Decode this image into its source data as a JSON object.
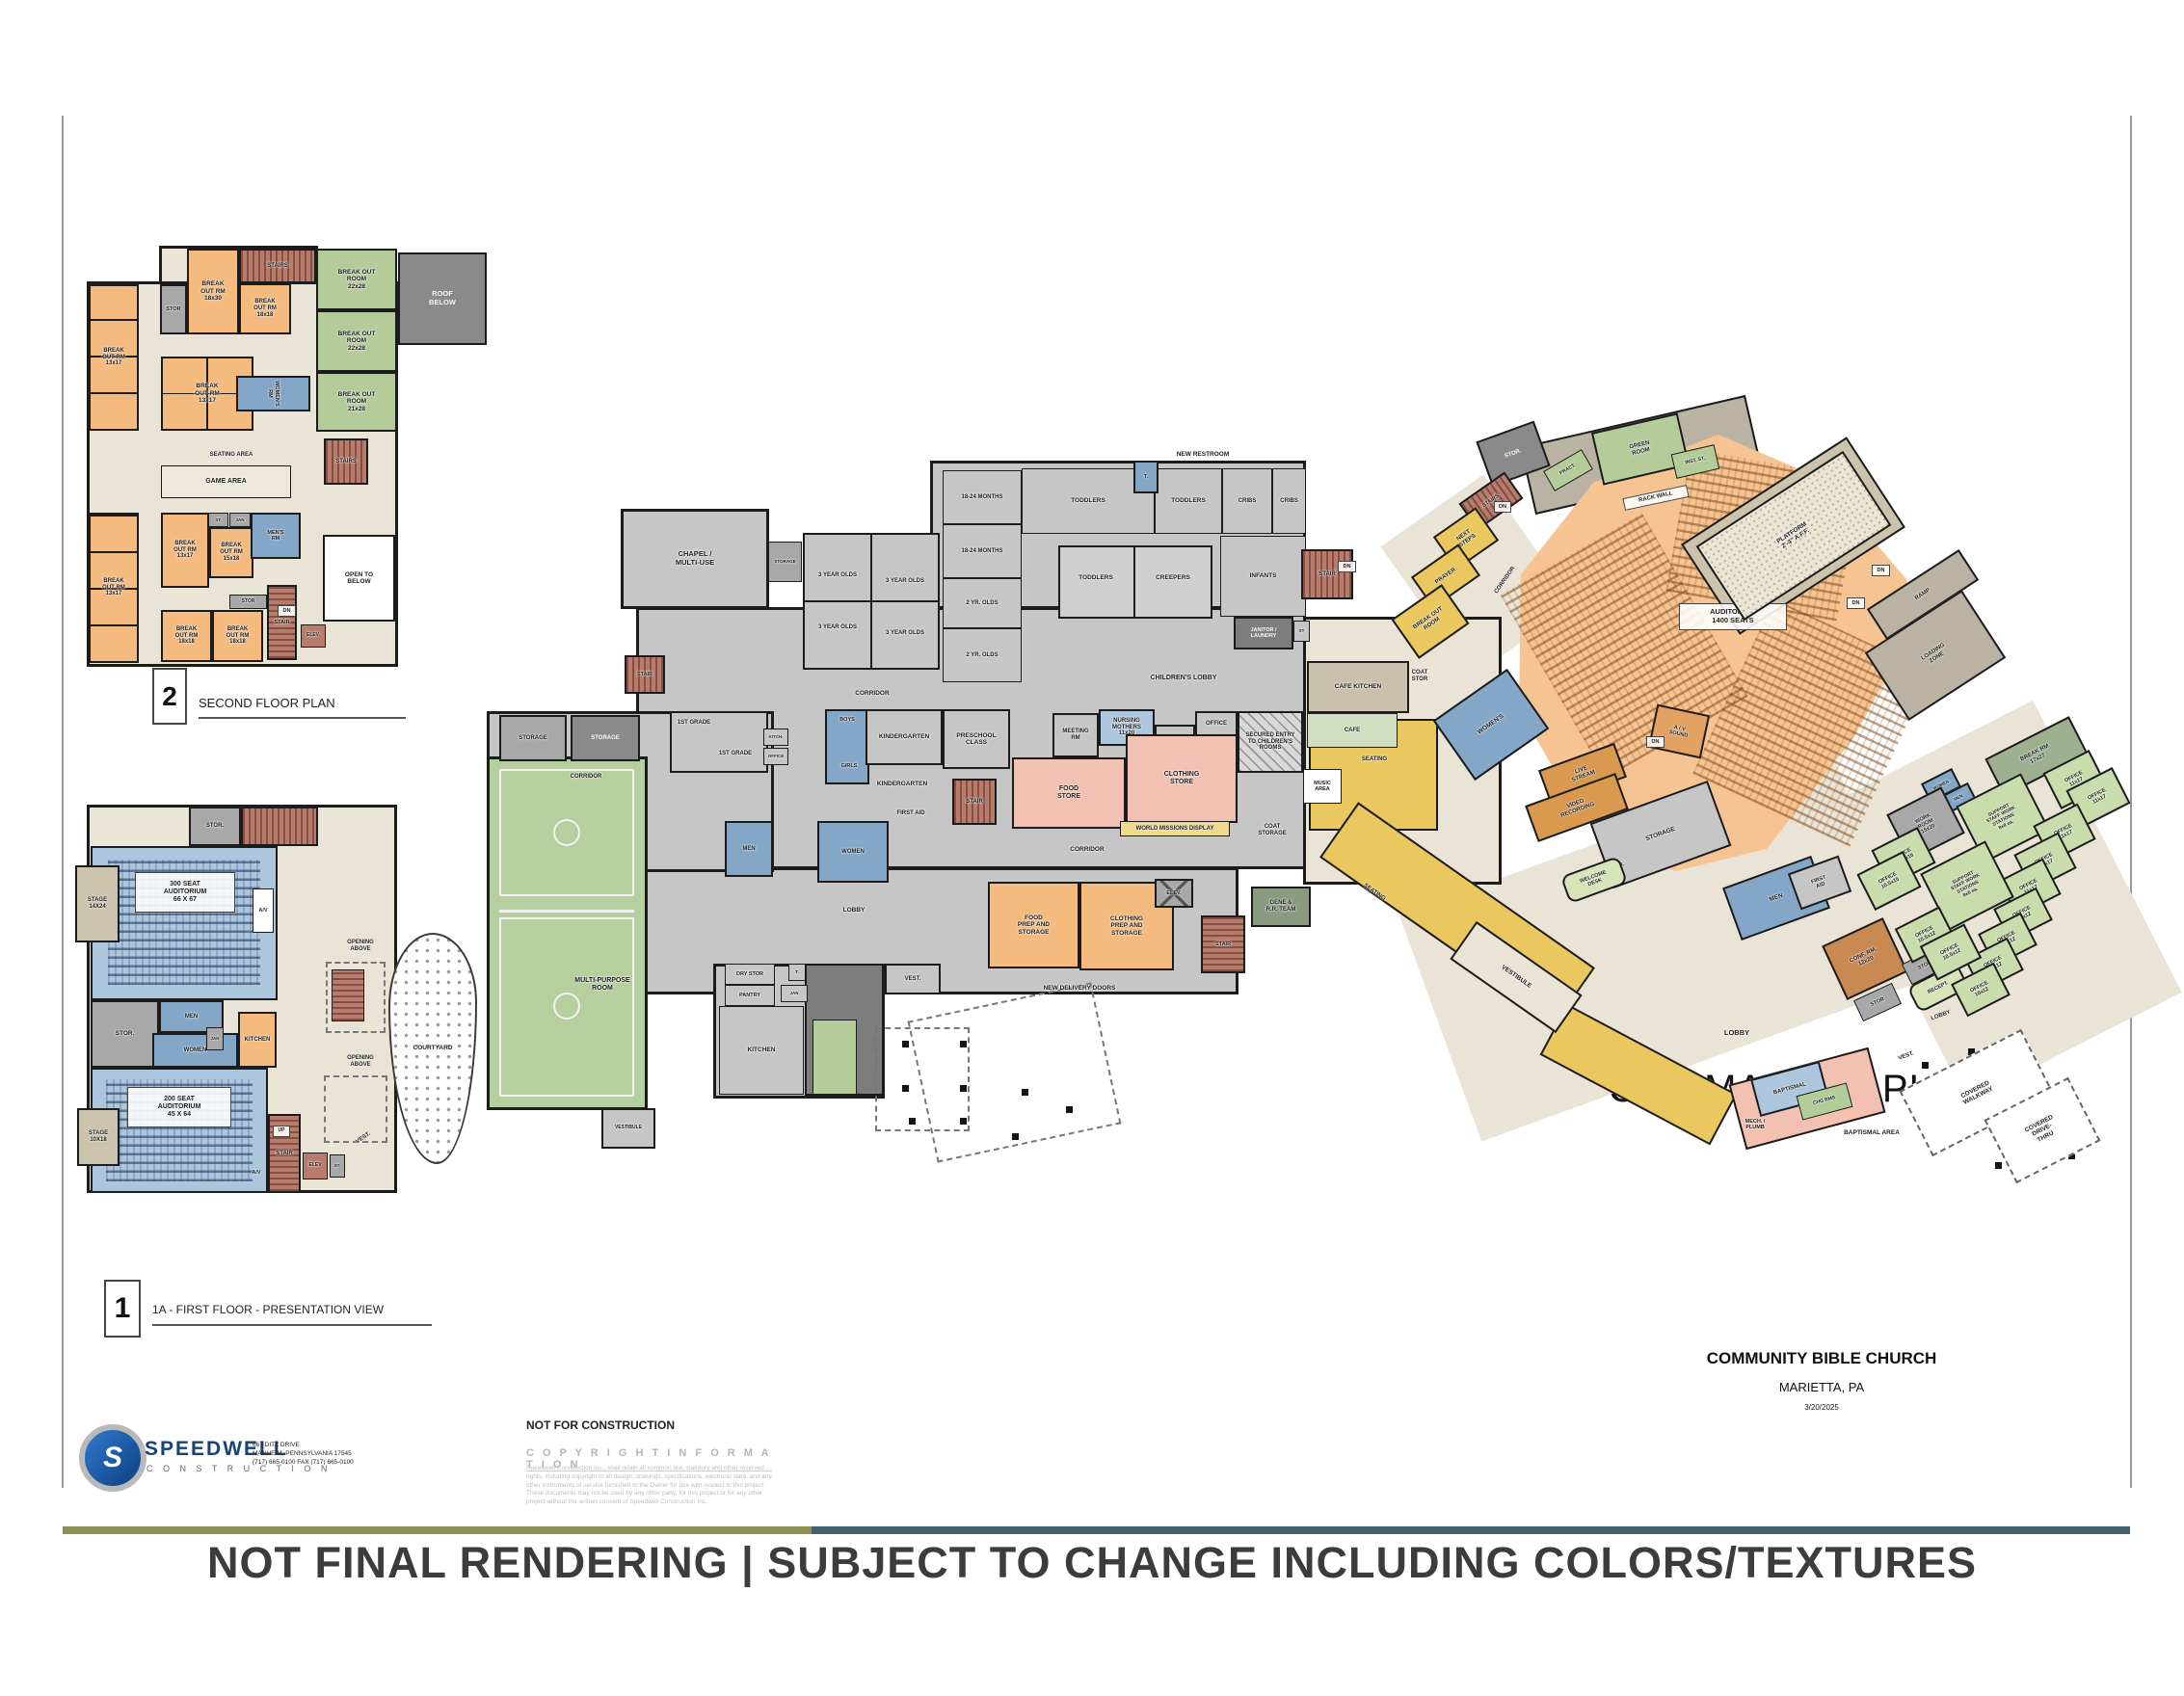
{
  "title": "CBC MASTER PLAN",
  "plans": {
    "second": {
      "number": "2",
      "label": "SECOND FLOOR PLAN"
    },
    "first": {
      "number": "1",
      "label": "1A - FIRST FLOOR - PRESENTATION VIEW"
    }
  },
  "footer": {
    "company": "SPEEDWELL",
    "company_sub": "C O N S T R U C T I O N",
    "address_line1": "667 DITZ DRIVE",
    "address_line2": "MANHEIM, PENNSYLVANIA 17545",
    "address_line3": "(717) 665-0100  FAX (717) 665-0100",
    "not_for_construction": "NOT FOR CONSTRUCTION",
    "copyright_title": "C O P Y R I G H T   I N F O R M A T I O N",
    "copyright_body": "Speedwell Construction Inc., shall retain all common law, statutory and other reserved rights, including copyright to all design, drawings, specifications, electronic data, and any other instruments of service furnished to the Owner for use with respect to this project. These documents may not be used by any other party, for this project or for any other project without the written consent of Speedwell Construction Inc.",
    "project": "COMMUNITY BIBLE CHURCH",
    "location": "MARIETTA, PA",
    "date": "3/20/2025",
    "disclaimer": "NOT FINAL RENDERING | SUBJECT TO CHANGE INCLUDING COLORS/TEXTURES"
  },
  "rooms": [
    {
      "id": "s_stairs_top",
      "label": "STAIRS"
    },
    {
      "id": "s_bo22a",
      "label": "BREAK OUT\nROOM\n22x28"
    },
    {
      "id": "s_bo22b",
      "label": "BREAK OUT\nROOM\n22x28"
    },
    {
      "id": "s_bo21",
      "label": "BREAK OUT\nROOM\n21x28"
    },
    {
      "id": "s_roof",
      "label": "ROOF\nBELOW"
    },
    {
      "id": "s_stor_top",
      "label": "STOR"
    },
    {
      "id": "s_bo1830",
      "label": "BREAK\nOUT RM\n18x30"
    },
    {
      "id": "s_bo1818",
      "label": "BREAK\nOUT RM\n18x18"
    },
    {
      "id": "s_col1",
      "label": "BREAK\nOUT RM\n13x17"
    },
    {
      "id": "s_blk1",
      "label": "BREAK\nOUT RM\n13x17"
    },
    {
      "id": "s_womens",
      "label": "WOMEN'S\nRM"
    },
    {
      "id": "s_seating_lbl",
      "label": "SEATING AREA"
    },
    {
      "id": "s_game",
      "label": "GAME AREA"
    },
    {
      "id": "s_stairR",
      "label": "STAIRS"
    },
    {
      "id": "s_col2",
      "label": "BREAK\nOUT RM\n13x17"
    },
    {
      "id": "s_blk2",
      "label": "BREAK\nOUT RM\n13x17"
    },
    {
      "id": "s_bo1518",
      "label": "BREAK\nOUT RM\n15x18"
    },
    {
      "id": "s_st",
      "label": "ST."
    },
    {
      "id": "s_jan",
      "label": "JAN"
    },
    {
      "id": "s_mens",
      "label": "MEN'S\nRM"
    },
    {
      "id": "s_stor2",
      "label": "STOR"
    },
    {
      "id": "s_stair2",
      "label": "STAIR"
    },
    {
      "id": "s_dn",
      "label": "DN"
    },
    {
      "id": "s_elev",
      "label": "ELEV."
    },
    {
      "id": "s_open",
      "label": "OPEN TO\nBELOW"
    },
    {
      "id": "s_bo18b1",
      "label": "BREAK\nOUT RM\n18x18"
    },
    {
      "id": "s_bo18b2",
      "label": "BREAK\nOUT RM\n18x18"
    },
    {
      "id": "f_stor_top",
      "label": "STOR."
    },
    {
      "id": "f_aud300",
      "label": "300 SEAT\nAUDITORIUM\n66 X 67"
    },
    {
      "id": "f_stage300",
      "label": "STAGE\n14X24"
    },
    {
      "id": "f_av1",
      "label": "A/V"
    },
    {
      "id": "f_stor_mid",
      "label": "STOR."
    },
    {
      "id": "f_men_l",
      "label": "MEN"
    },
    {
      "id": "f_women_l",
      "label": "WOMEN"
    },
    {
      "id": "f_jan_l",
      "label": "JAN"
    },
    {
      "id": "f_kitchen_l",
      "label": "KITCHEN"
    },
    {
      "id": "f_aud200",
      "label": "200 SEAT\nAUDITORIUM\n45 X 64"
    },
    {
      "id": "f_stage200",
      "label": "STAGE\n10X18"
    },
    {
      "id": "f_av2",
      "label": "A/V"
    },
    {
      "id": "f_stair_up",
      "label": "STAIR"
    },
    {
      "id": "f_up",
      "label": "UP"
    },
    {
      "id": "f_elev_l",
      "label": "ELEV"
    },
    {
      "id": "f_st_l",
      "label": "ST."
    },
    {
      "id": "f_vest_l",
      "label": "VEST."
    },
    {
      "id": "f_open1_lbl",
      "label": "OPENING\nABOVE"
    },
    {
      "id": "f_open2_lbl",
      "label": "OPENING\nABOVE"
    },
    {
      "id": "f_courtyard",
      "label": "COURTYARD"
    },
    {
      "id": "c_chapel",
      "label": "CHAPEL /\nMULTI-USE"
    },
    {
      "id": "c_storage_sm",
      "label": "STORAGE"
    },
    {
      "id": "c_storage_a",
      "label": "STORAGE"
    },
    {
      "id": "c_storage_b",
      "label": "STORAGE"
    },
    {
      "id": "c_corridor_w",
      "label": "CORRIDOR"
    },
    {
      "id": "c_1st_a",
      "label": "1ST GRADE"
    },
    {
      "id": "c_1st_b",
      "label": "1ST GRADE"
    },
    {
      "id": "c_kitch",
      "label": "KITCH."
    },
    {
      "id": "c_office_sm",
      "label": "OFFICE"
    },
    {
      "id": "c_stair_w",
      "label": "STAIR"
    },
    {
      "id": "c_boys",
      "label": "BOYS"
    },
    {
      "id": "c_girls",
      "label": "GIRLS"
    },
    {
      "id": "c_kind_a",
      "label": "KINDERGARTEN"
    },
    {
      "id": "c_kind_b",
      "label": "KINDERGARTEN"
    },
    {
      "id": "c_preschool",
      "label": "PRESCHOOL\nCLASS"
    },
    {
      "id": "c_stair_c",
      "label": "STAIR"
    },
    {
      "id": "c_corridor_top",
      "label": "CORRIDOR"
    },
    {
      "id": "c_18a",
      "label": "18-24 MONTHS"
    },
    {
      "id": "c_18b",
      "label": "18-24 MONTHS"
    },
    {
      "id": "c_2a",
      "label": "2 YR. OLDS"
    },
    {
      "id": "c_2b",
      "label": "2 YR. OLDS"
    },
    {
      "id": "c_tod_a",
      "label": "TODDLERS"
    },
    {
      "id": "c_tod_b",
      "label": "TODDLERS"
    },
    {
      "id": "c_cribs_a",
      "label": "CRIBS"
    },
    {
      "id": "c_cribs_b",
      "label": "CRIBS"
    },
    {
      "id": "c_t_rr",
      "label": "T."
    },
    {
      "id": "c_new_rr",
      "label": "NEW RESTROOM"
    },
    {
      "id": "c_tod_c",
      "label": "TODDLERS"
    },
    {
      "id": "c_creepers",
      "label": "CREEPERS"
    },
    {
      "id": "c_infants",
      "label": "INFANTS"
    },
    {
      "id": "c_janitor",
      "label": "JANITOR /\nLAUNDRY"
    },
    {
      "id": "c_st2",
      "label": "ST"
    },
    {
      "id": "c_stair_ne",
      "label": "STAIR"
    },
    {
      "id": "c_dn_ne",
      "label": "DN"
    },
    {
      "id": "c_chl_lobby",
      "label": "CHILDREN'S LOBBY"
    },
    {
      "id": "c_3a",
      "label": "3 YEAR OLDS"
    },
    {
      "id": "c_3b",
      "label": "3 YEAR OLDS"
    },
    {
      "id": "c_3c",
      "label": "3 YEAR OLDS"
    },
    {
      "id": "c_3d",
      "label": "3 YEAR OLDS"
    },
    {
      "id": "c_meeting",
      "label": "MEETING\nRM"
    },
    {
      "id": "c_nursing",
      "label": "NURSING\nMOTHERS\n11x20"
    },
    {
      "id": "c_mech",
      "label": "MECH.\n/ ELEC."
    },
    {
      "id": "c_office2",
      "label": "OFFICE"
    },
    {
      "id": "c_secured",
      "label": "SECURED ENTRY\nTO CHILDREN'S\nROOMS"
    },
    {
      "id": "c_food_store",
      "label": "FOOD\nSTORE"
    },
    {
      "id": "c_cloth_store",
      "label": "CLOTHING\nSTORE"
    },
    {
      "id": "c_world",
      "label": "WORLD MISSIONS DISPLAY"
    },
    {
      "id": "c_coat",
      "label": "COAT\nSTORAGE"
    },
    {
      "id": "c_men_c",
      "label": "MEN"
    },
    {
      "id": "c_women_c",
      "label": "WOMEN"
    },
    {
      "id": "c_first_aid",
      "label": "FIRST AID"
    },
    {
      "id": "c_lobby",
      "label": "LOBBY"
    },
    {
      "id": "c_corridor_s",
      "label": "CORRIDOR"
    },
    {
      "id": "c_food_prep",
      "label": "FOOD\nPREP AND\nSTORAGE"
    },
    {
      "id": "c_cloth_prep",
      "label": "CLOTHING\nPREP AND\nSTORAGE"
    },
    {
      "id": "c_elev",
      "label": "ELEV."
    },
    {
      "id": "c_stair_s",
      "label": "STAIR"
    },
    {
      "id": "c_gene",
      "label": "GENE &\nR.R. TEAM"
    },
    {
      "id": "c_mpr",
      "label": "MULTI-PURPOSE\nROOM"
    },
    {
      "id": "c_vest_gym",
      "label": "VESTIBULE"
    },
    {
      "id": "c_vest_a",
      "label": "VEST."
    },
    {
      "id": "c_dry",
      "label": "DRY STOR"
    },
    {
      "id": "c_pantry",
      "label": "PANTRY"
    },
    {
      "id": "c_t2",
      "label": "T."
    },
    {
      "id": "c_jan2",
      "label": "JAN"
    },
    {
      "id": "c_kitchen2",
      "label": "KITCHEN"
    },
    {
      "id": "c_delivery",
      "label": "NEW DELIVERY DOORS"
    },
    {
      "id": "r_cafe_k",
      "label": "CAFE KITCHEN"
    },
    {
      "id": "r_cafe",
      "label": "CAFE"
    },
    {
      "id": "r_coat2",
      "label": "COAT\nSTOR"
    },
    {
      "id": "r_seating_a",
      "label": "SEATING"
    },
    {
      "id": "r_music",
      "label": "MUSIC\nAREA"
    },
    {
      "id": "r_women_r",
      "label": "WOMEN'S"
    },
    {
      "id": "r_stor_top",
      "label": "STOR."
    },
    {
      "id": "r_green",
      "label": "GREEN\nROOM"
    },
    {
      "id": "r_inst",
      "label": "INST. ST."
    },
    {
      "id": "r_pract",
      "label": "PRACT."
    },
    {
      "id": "r_rack",
      "label": "RACK WALL"
    },
    {
      "id": "r_stairs_n",
      "label": "STAIRS"
    },
    {
      "id": "r_dn1",
      "label": "DN"
    },
    {
      "id": "r_next",
      "label": "NEXT\nSTEPS"
    },
    {
      "id": "r_prayer",
      "label": "PRAYER"
    },
    {
      "id": "r_bo",
      "label": "BREAK OUT\nROOM"
    },
    {
      "id": "r_corr",
      "label": "CORRIDOR"
    },
    {
      "id": "r_aud_lbl",
      "label": "AUDITORIUM\n1400 SEATS"
    },
    {
      "id": "r_platform",
      "label": "PLATFORM\n2'-4\" A.F.F."
    },
    {
      "id": "r_dn_a",
      "label": "DN"
    },
    {
      "id": "r_dn_b",
      "label": "DN"
    },
    {
      "id": "r_ramp",
      "label": "RAMP"
    },
    {
      "id": "r_loading",
      "label": "LOADING\nZONE"
    },
    {
      "id": "r_av",
      "label": "A / V\nSOUND"
    },
    {
      "id": "r_dn_c",
      "label": "DN"
    },
    {
      "id": "r_live",
      "label": "LIVE\nSTREAM"
    },
    {
      "id": "r_video",
      "label": "VIDEO\nRECORDING"
    },
    {
      "id": "r_storage_b",
      "label": "STORAGE"
    },
    {
      "id": "r_stor_s",
      "label": "STOR."
    },
    {
      "id": "r_welcome",
      "label": "WELCOME\nDESK"
    },
    {
      "id": "r_lobby_m",
      "label": "LOBBY"
    },
    {
      "id": "r_seating_b2",
      "label": "SEATING"
    },
    {
      "id": "r_vestib",
      "label": "VESTIBULE"
    },
    {
      "id": "r_bapt",
      "label": "BAPTISMAL"
    },
    {
      "id": "r_chg",
      "label": "CHG RMS"
    },
    {
      "id": "r_mechp",
      "label": "MECH. /\nPLUMB"
    },
    {
      "id": "r_bapt_lbl",
      "label": "BAPTISMAL AREA"
    },
    {
      "id": "r_men_s",
      "label": "MEN"
    },
    {
      "id": "r_faid",
      "label": "FIRST\nAID"
    },
    {
      "id": "r_conf",
      "label": "CONF. RM.\n12x20"
    },
    {
      "id": "r_storb2",
      "label": "STOR"
    },
    {
      "id": "r_stora2",
      "label": "STOR"
    },
    {
      "id": "r_recept",
      "label": "RECEPT."
    },
    {
      "id": "r_lobby2",
      "label": "LOBBY"
    },
    {
      "id": "r_vest2",
      "label": "VEST."
    },
    {
      "id": "r_breakrm",
      "label": "BREAK RM\n17x27"
    },
    {
      "id": "r_o17a",
      "label": "OFFICE\n11x17"
    },
    {
      "id": "r_o17b",
      "label": "OFFICE\n11x17"
    },
    {
      "id": "r_wsm",
      "label": "WOMEN"
    },
    {
      "id": "r_msm",
      "label": "MEN"
    },
    {
      "id": "r_work",
      "label": "WORK\nROOM\n15x20"
    },
    {
      "id": "r_supa",
      "label": "SUPPORT\nSTAFF WORK\nSTATIONS\n8x8 ea."
    },
    {
      "id": "r_o17c",
      "label": "OFFICE\n11x17"
    },
    {
      "id": "r_o17d",
      "label": "OFFICE\n11x17"
    },
    {
      "id": "r_o17e",
      "label": "OFFICE\n11x17"
    },
    {
      "id": "r_o15a",
      "label": "OFFICE\n10.5x15"
    },
    {
      "id": "r_o15b",
      "label": "OFFICE\n10.5x15"
    },
    {
      "id": "r_supb",
      "label": "SUPPORT\nSTAFF WORK\nSTATIONS\n8x8 ea."
    },
    {
      "id": "r_o12a",
      "label": "OFFICE\n10x12"
    },
    {
      "id": "r_o12b",
      "label": "OFFICE\n10x12"
    },
    {
      "id": "r_o12c",
      "label": "OFFICE\n10x12"
    },
    {
      "id": "r_o12d",
      "label": "OFFICE\n10x12"
    },
    {
      "id": "r_o512a",
      "label": "OFFICE\n10.5x12"
    },
    {
      "id": "r_o512b",
      "label": "OFFICE\n10.5x12"
    },
    {
      "id": "r_walkway",
      "label": "COVERED\nWALKWAY"
    },
    {
      "id": "r_drive",
      "label": "COVERED\nDRIVE-\nTHRU"
    }
  ]
}
